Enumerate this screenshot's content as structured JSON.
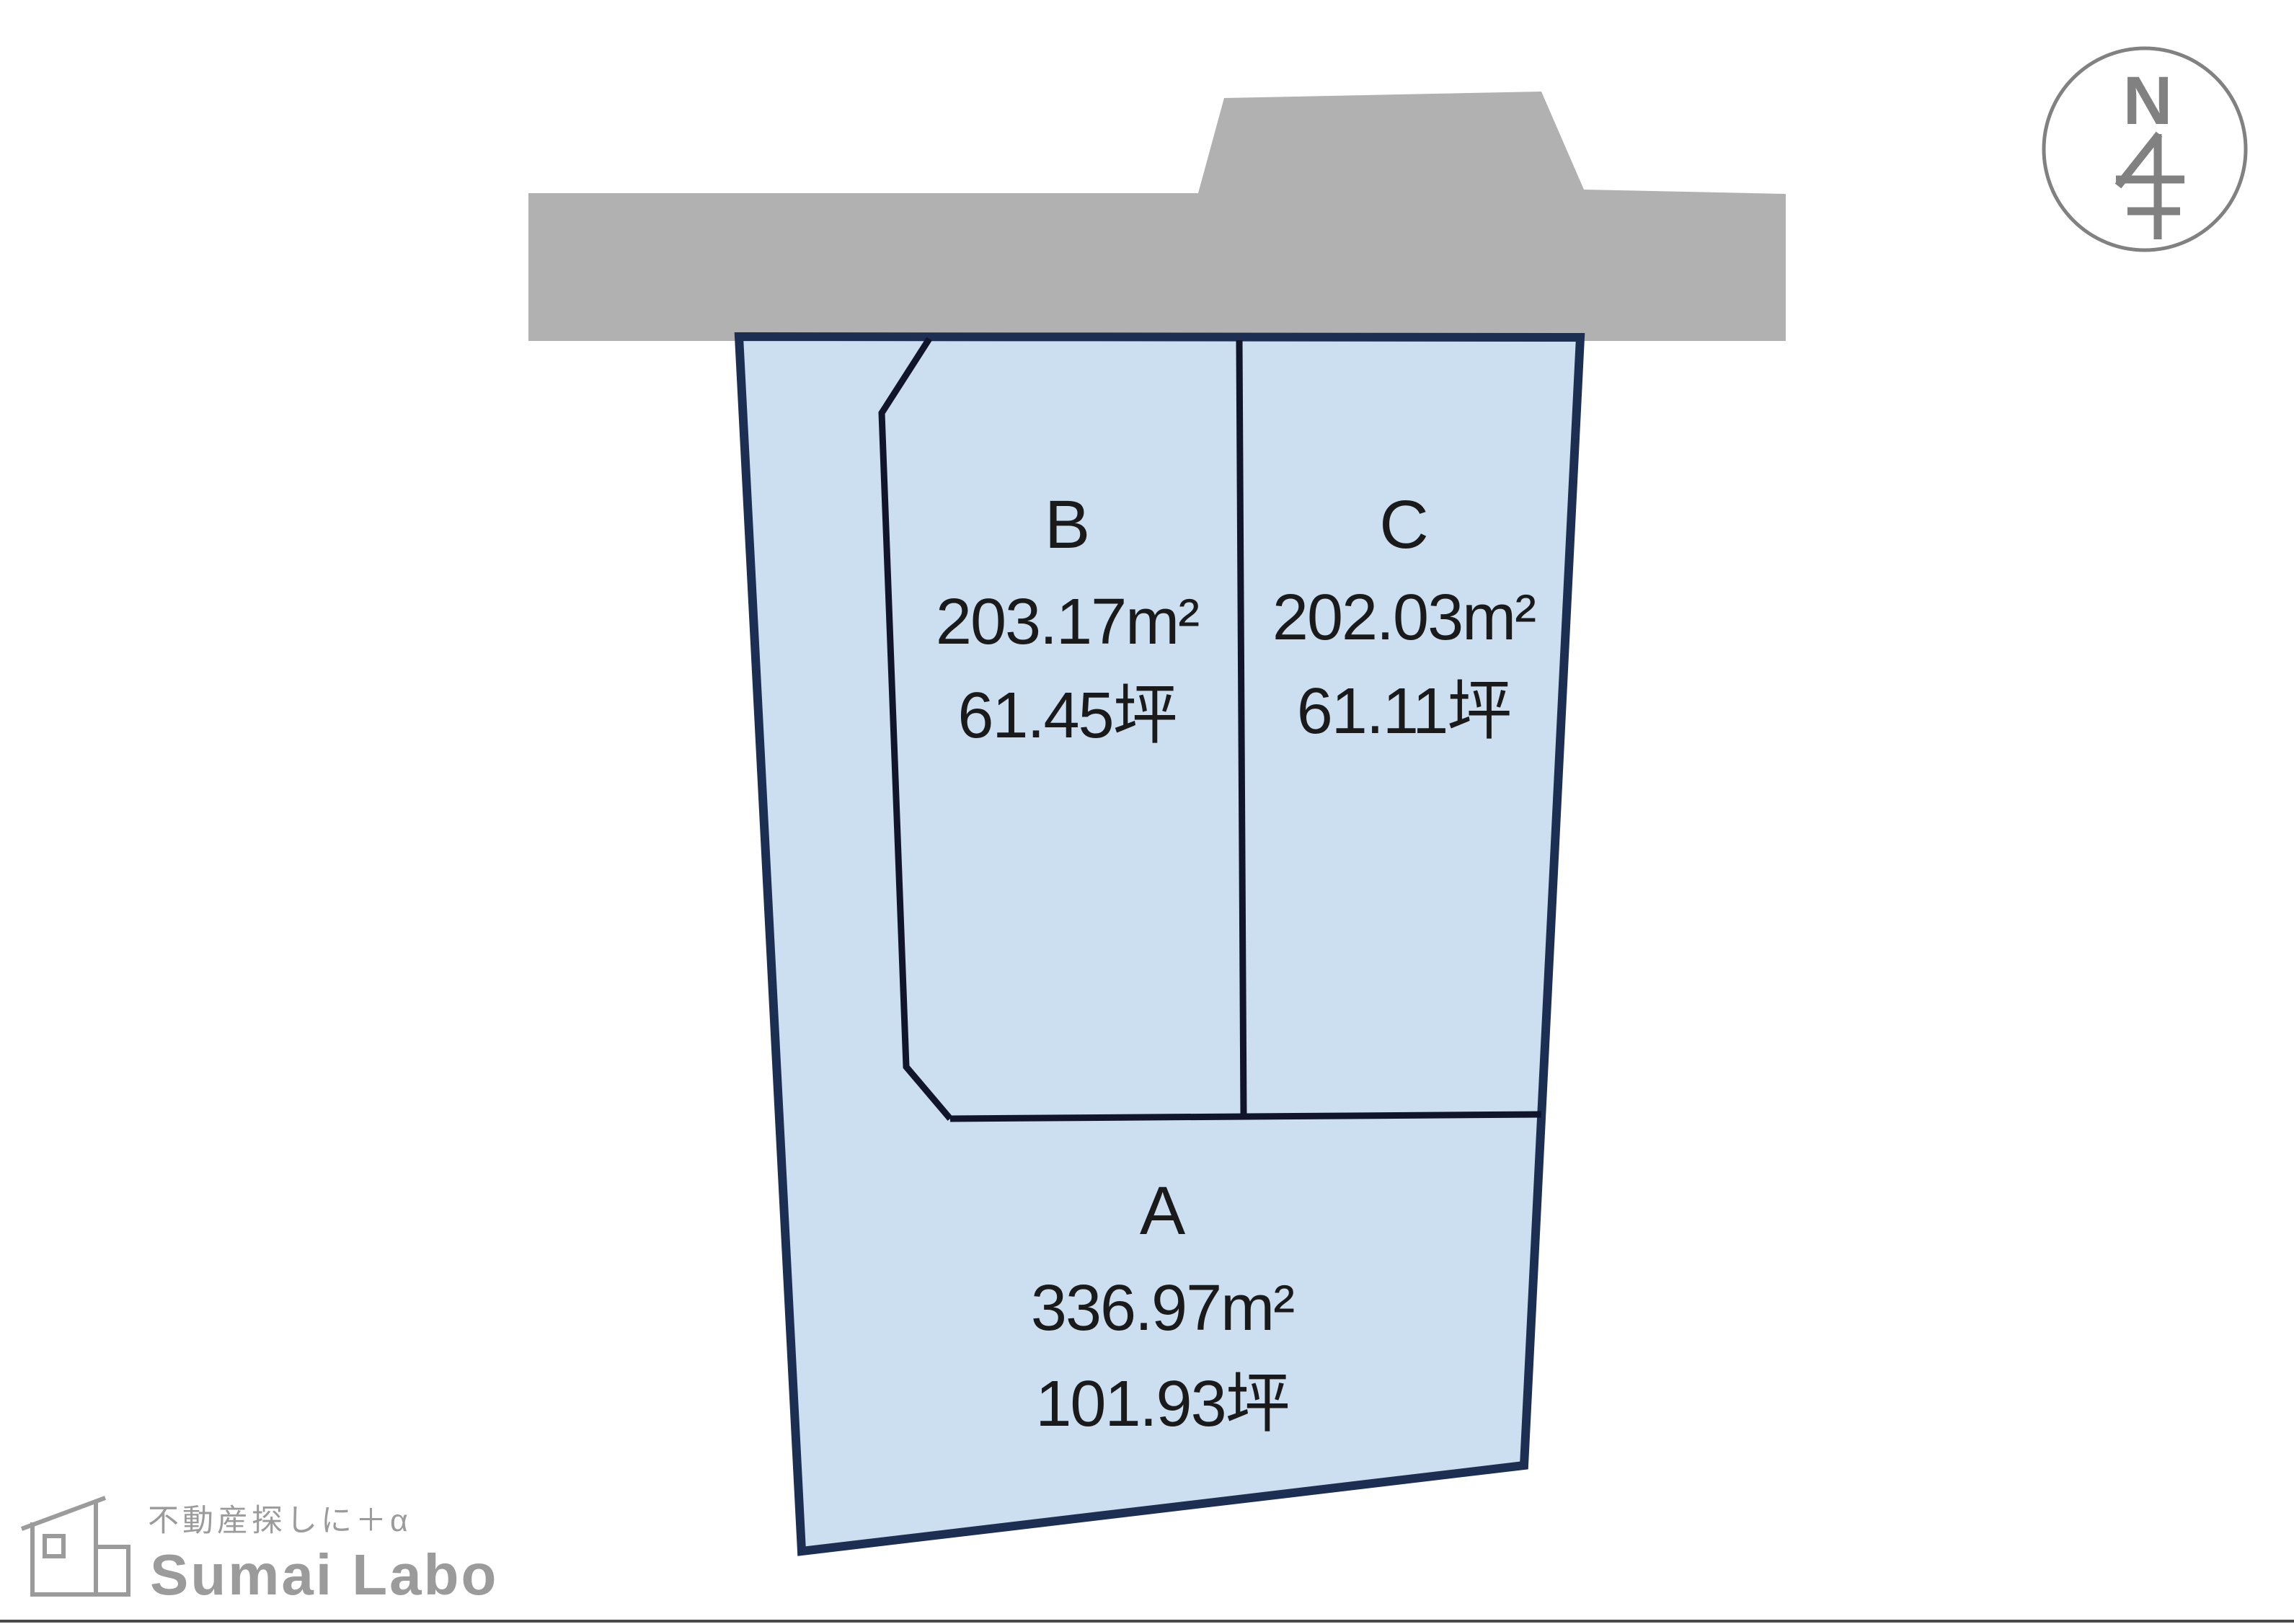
{
  "north_indicator": {
    "label": "N"
  },
  "parcel": {
    "sections": [
      {
        "id": "B",
        "label": "B",
        "area_m2": "203.17m²",
        "area_tsubo": "61.45坪"
      },
      {
        "id": "C",
        "label": "C",
        "area_m2": "202.03m²",
        "area_tsubo": "61.11坪"
      },
      {
        "id": "A",
        "label": "A",
        "area_m2": "336.97m²",
        "area_tsubo": "101.93坪"
      }
    ]
  },
  "logo": {
    "tagline": "不動産探しに＋α",
    "name": "Sumai Labo"
  },
  "colors": {
    "background": "#ffffff",
    "road": "#b1b1b1",
    "parcel_fill": "#cbdff1",
    "parcel_border": "#1c2e52",
    "inner_line": "#10152b",
    "text": "#1a1a1a",
    "compass": "#818181",
    "logo": "#9b9b9b",
    "bottom_rule": "#4a4a4a"
  }
}
